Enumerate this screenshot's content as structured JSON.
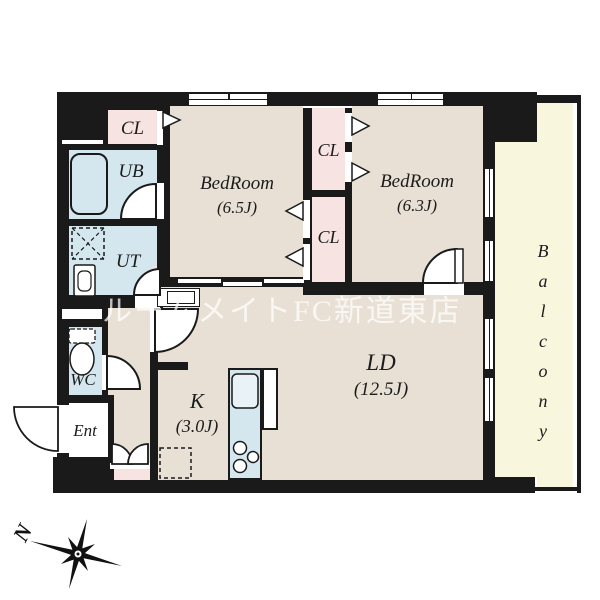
{
  "watermark": "ルームメイトFC新道東店",
  "compass": {
    "north_label": "N"
  },
  "colors": {
    "wall": "#1a1a1a",
    "room": "#e8e0d4",
    "closet": "#f7e4e2",
    "wet": "#d4e7ef",
    "balcony": "#f8f6dc"
  },
  "rooms": {
    "closet_entry": {
      "label": "CL"
    },
    "unit_bath": {
      "label": "UB"
    },
    "utility": {
      "label": "UT"
    },
    "toilet": {
      "label": "WC"
    },
    "entrance": {
      "label": "Ent"
    },
    "bedroom_1": {
      "label": "BedRoom",
      "size": "(6.5J)"
    },
    "bedroom_2": {
      "label": "BedRoom",
      "size": "(6.3J)"
    },
    "closet_mid_upper": {
      "label": "CL"
    },
    "closet_mid_lower": {
      "label": "CL"
    },
    "living_dining": {
      "label": "LD",
      "size": "(12.5J)"
    },
    "kitchen": {
      "label": "K",
      "size": "(3.0J)"
    },
    "balcony": {
      "label": "Balcony"
    }
  }
}
